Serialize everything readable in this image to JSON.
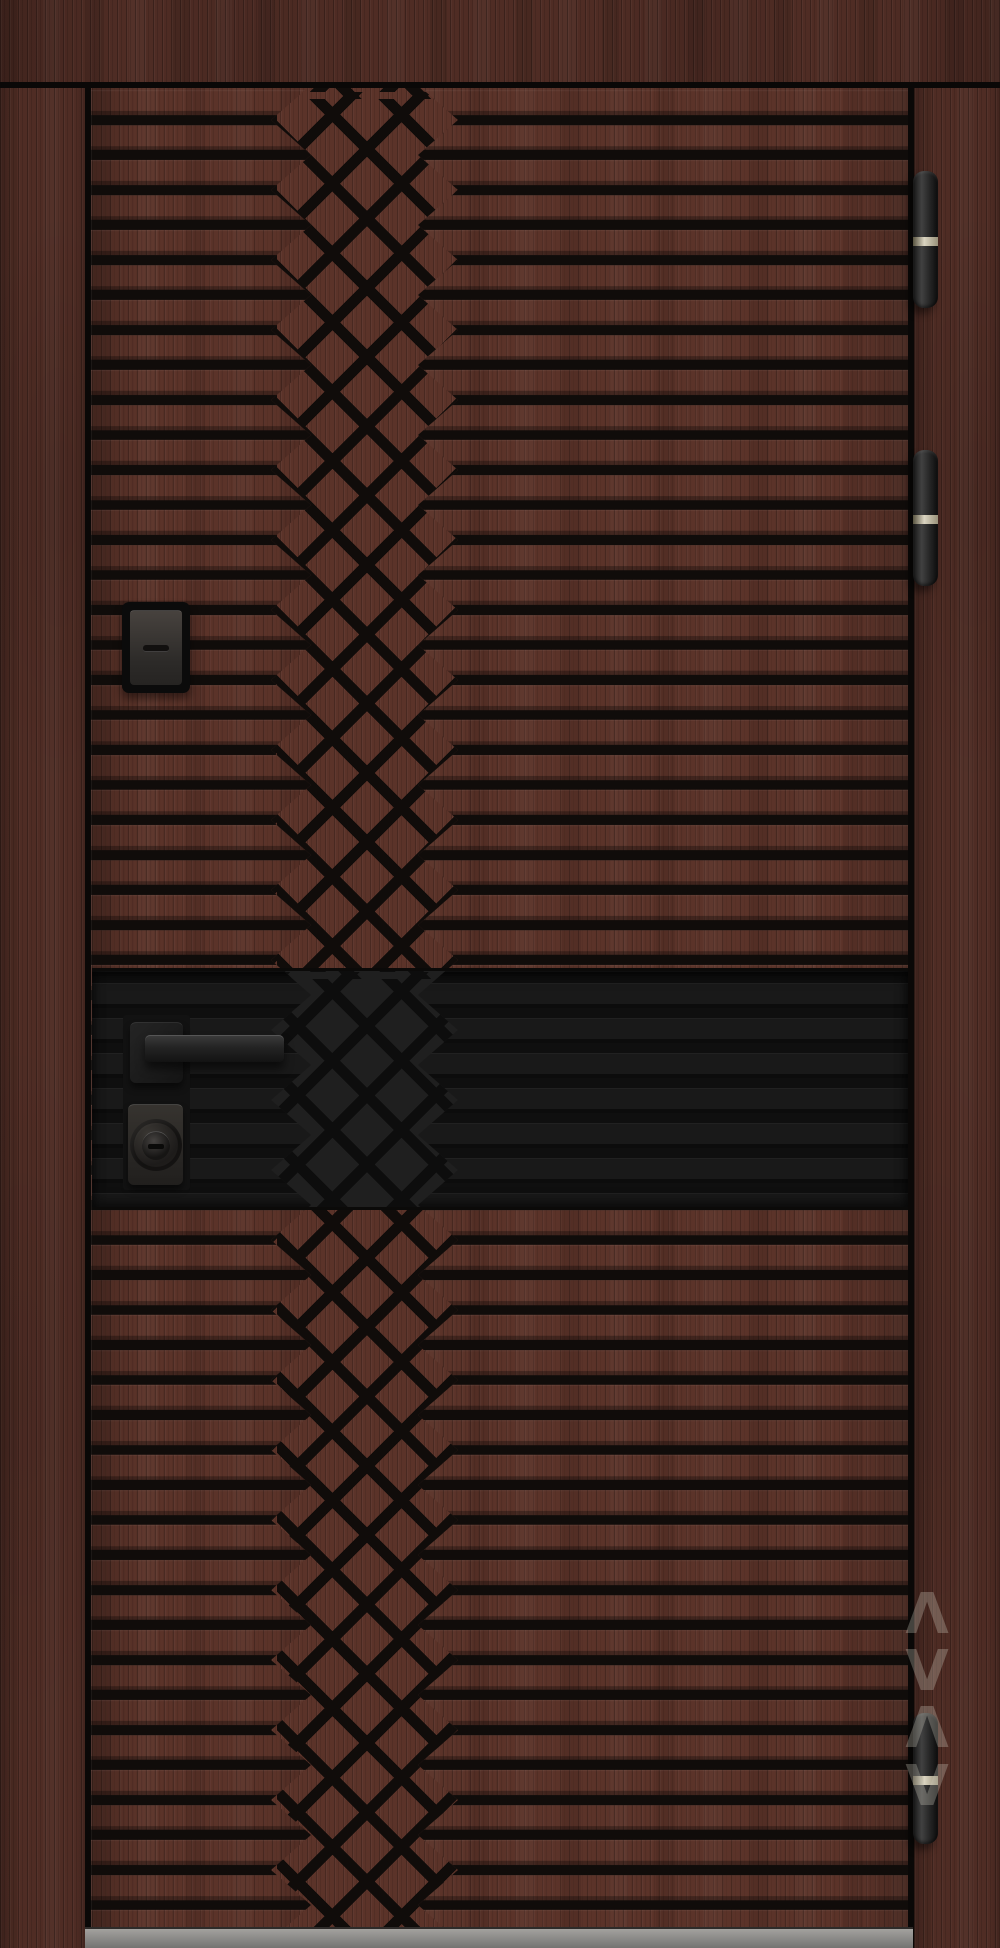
{
  "scene": {
    "title": "Entrance door product photo",
    "description": "Front view of a closed entrance door finished in dark red-brown wood grain with horizontal milled grooves, a central woven diamond lattice strip set left of centre, a matte black horizontal accent band carrying a square-rosette lever handle and cylinder lock, three black barrel hinges on the right edge, a small black viewer plate on the left stile, and a grey sill at the bottom.",
    "orientation": "portrait"
  },
  "door": {
    "frame": {
      "top": "lintel, dark wood grain",
      "left": "left jamb, dark wood grain",
      "right": "right jamb, dark wood grain"
    },
    "leaf": {
      "finish": "dark red-brown wood grain",
      "pattern": {
        "horizontal_grooves": true,
        "groove_pitch_px": 35,
        "central_lattice": "woven diamond grid with chevron slat ends",
        "lattice_position": "left of door centre"
      }
    },
    "accent_band": {
      "finish": "matte black with faint grooves and lattice",
      "contains": [
        "lever handle",
        "cylinder lock"
      ]
    },
    "hardware": {
      "handle": {
        "type": "square-rosette lever",
        "finish": "matte black"
      },
      "lock": {
        "type": "cylinder escutcheon with round boss and keyway",
        "finish": "matte black"
      },
      "viewer": {
        "type": "rectangular viewer plate with horizontal slot",
        "finish": "black"
      },
      "hinges": {
        "count": 3,
        "style": "barrel",
        "finish": "black with steel centre ring"
      }
    },
    "threshold": {
      "material": "grey metal sill"
    }
  },
  "watermark": {
    "glyphs": [
      "Λ",
      "V",
      "Λ",
      "V"
    ],
    "opacity": 0.3,
    "legible": false
  },
  "colors": {
    "wood_base": "#5b3329",
    "wood_frame": "#4f2c24",
    "groove": "#100c0a",
    "band": "#191919",
    "band_groove": "#0f0f0f",
    "band_diamond": "#1f1f1f",
    "hinge_ring": "#cdc7b4",
    "threshold": "#8e8d8b",
    "background_gap": "#0a0807"
  }
}
